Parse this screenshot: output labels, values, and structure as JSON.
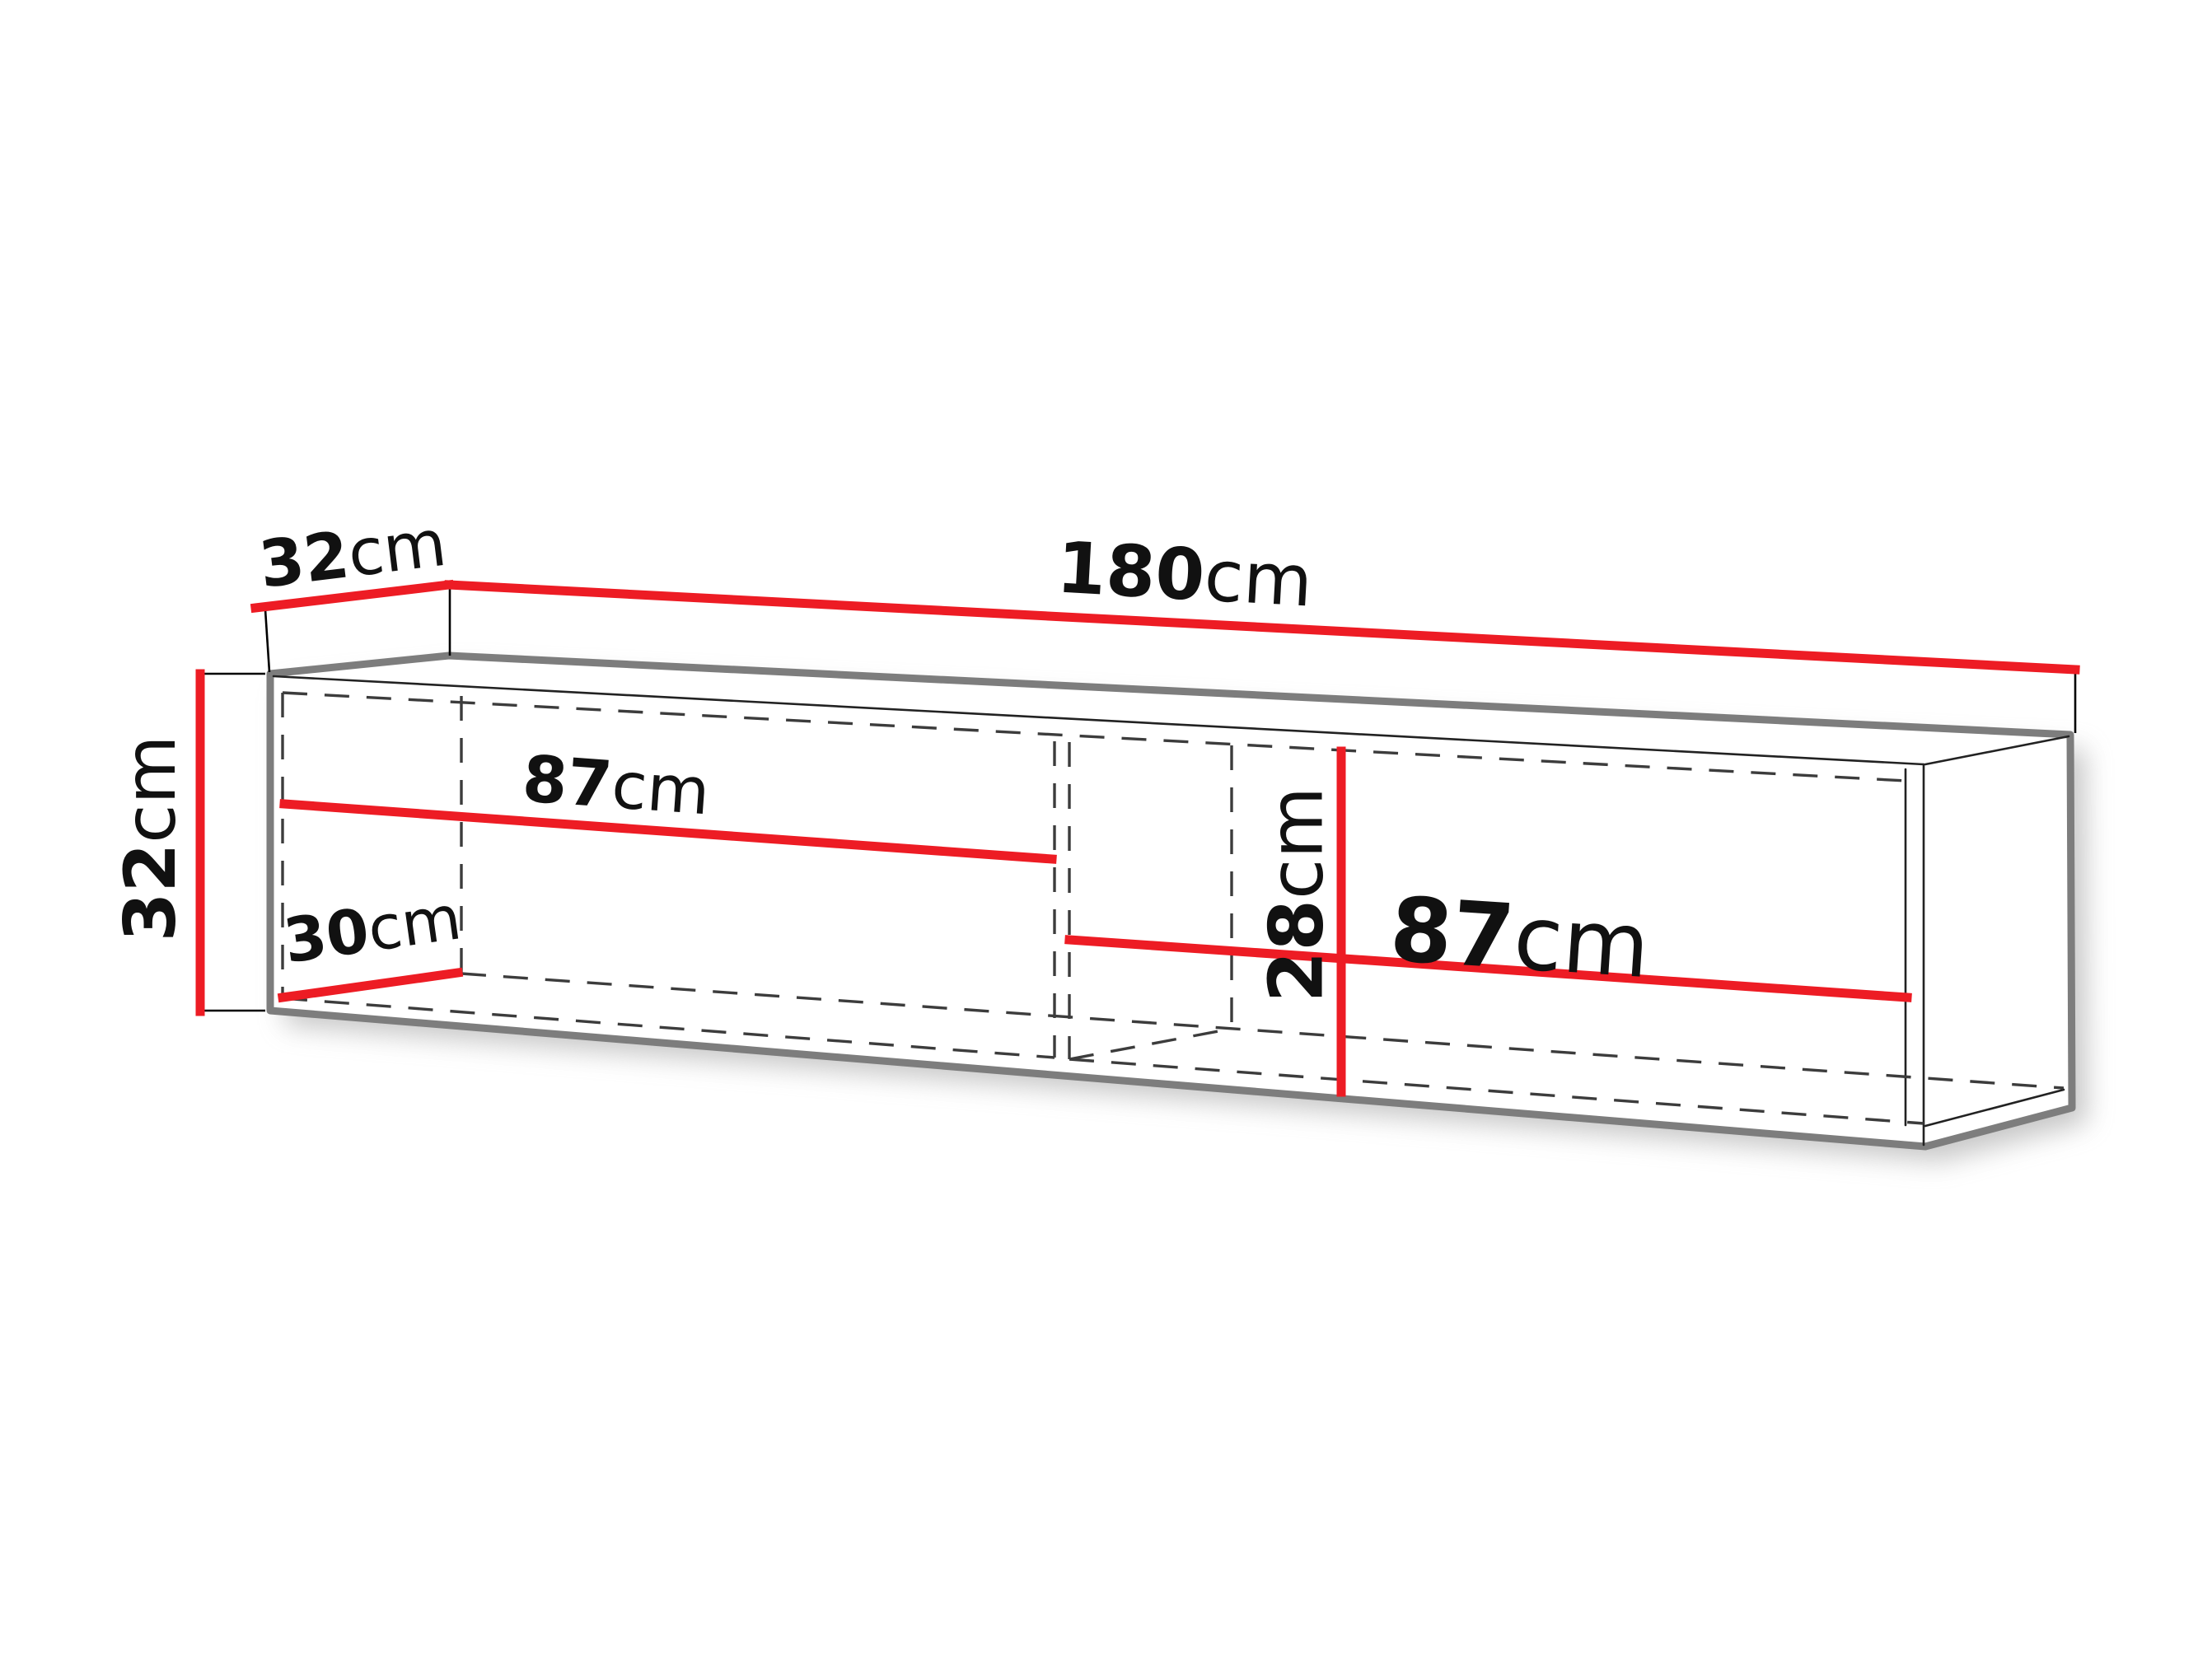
{
  "dimensions": {
    "top_depth": {
      "value": "32",
      "unit": "cm"
    },
    "top_width": {
      "value": "180",
      "unit": "cm"
    },
    "left_height": {
      "value": "32",
      "unit": "cm"
    },
    "left_compartment_width": {
      "value": "87",
      "unit": "cm"
    },
    "interior_depth": {
      "value": "30",
      "unit": "cm"
    },
    "interior_height": {
      "value": "28",
      "unit": "cm"
    },
    "right_compartment_width": {
      "value": "87",
      "unit": "cm"
    }
  },
  "colors": {
    "dimension_line": "#ed1c24",
    "silhouette": "#7d7d7d",
    "edge": "#222222",
    "hidden_edge": "#3c3c3c",
    "label_text": "#111111",
    "background": "#ffffff"
  }
}
